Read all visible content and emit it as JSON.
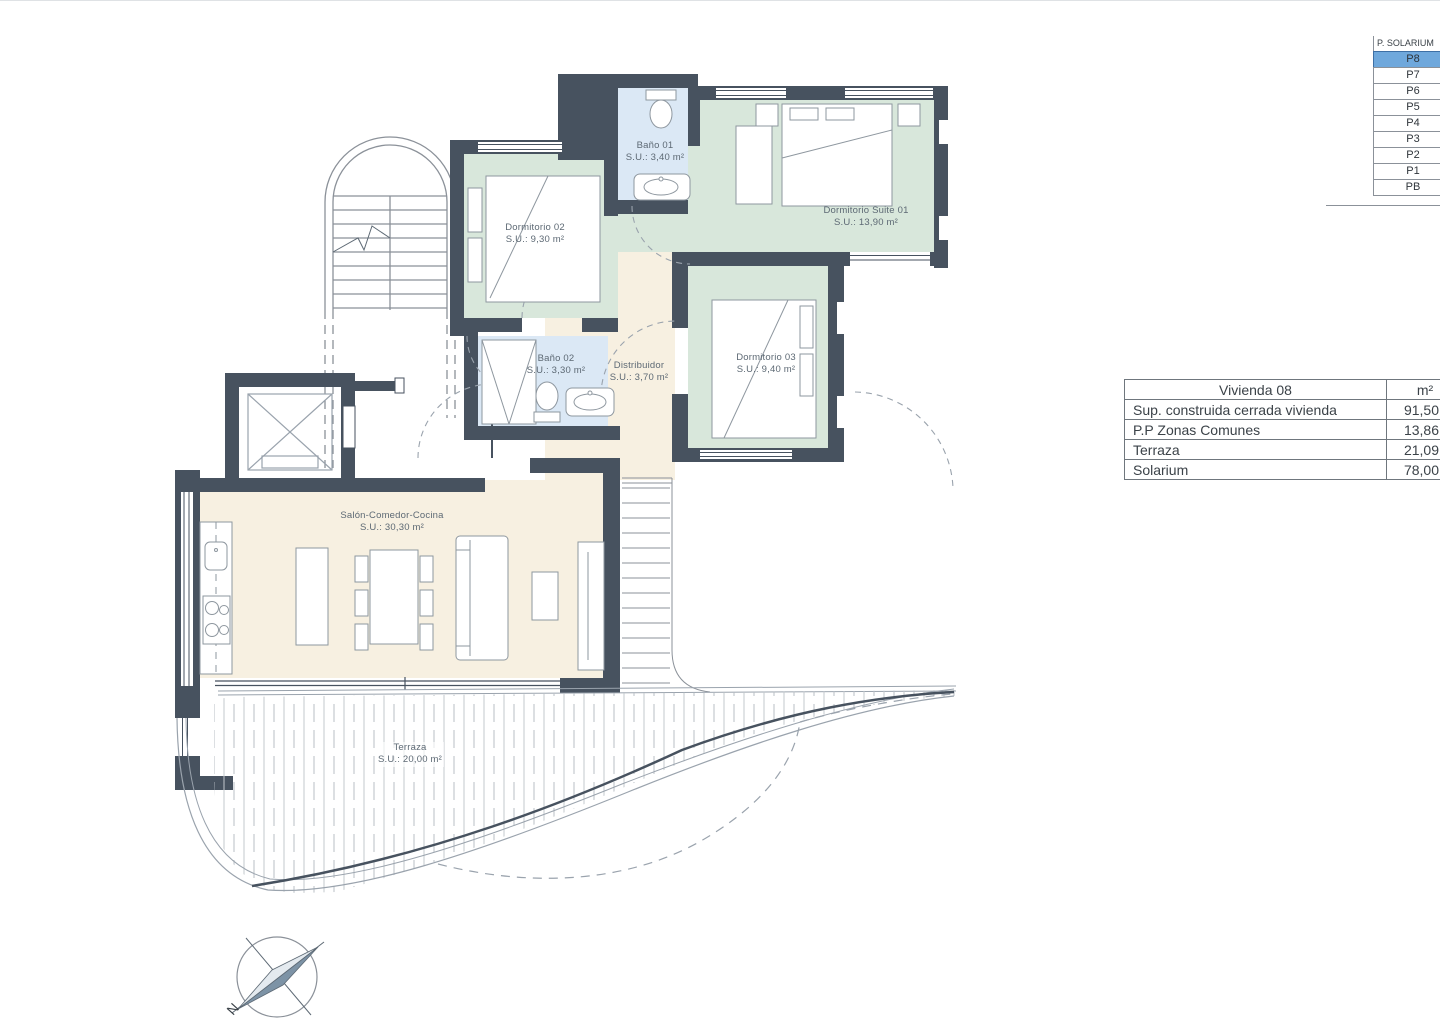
{
  "floor_selector": {
    "title": "P. SOLARIUM",
    "selected": "P8",
    "highlight_color": "#6fa8dc",
    "floors": [
      "P8",
      "P7",
      "P6",
      "P5",
      "P4",
      "P3",
      "P2",
      "P1",
      "PB"
    ]
  },
  "area_table": {
    "header": {
      "title": "Vivienda 08",
      "unit": "m²"
    },
    "rows": [
      {
        "label": "Sup. construida cerrada vivienda",
        "value": "91,50"
      },
      {
        "label": "P.P Zonas Comunes",
        "value": "13,86"
      },
      {
        "label": "Terraza",
        "value": "21,09"
      },
      {
        "label": "Solarium",
        "value": "78,00"
      }
    ]
  },
  "rooms": [
    {
      "name": "Baño 01",
      "area": "S.U.: 3,40 m²"
    },
    {
      "name": "Dormitorio 02",
      "area": "S.U.: 9,30 m²"
    },
    {
      "name": "Dormitorio Suite 01",
      "area": "S.U.: 13,90 m²"
    },
    {
      "name": "Dormitorio 03",
      "area": "S.U.: 9,40 m²"
    },
    {
      "name": "Baño 02",
      "area": "S.U.: 3,30 m²"
    },
    {
      "name": "Distribuidor",
      "area": "S.U.: 3,70 m²"
    },
    {
      "name": "Salón-Comedor-Cocina",
      "area": "S.U.: 30,30 m²"
    },
    {
      "name": "Terraza",
      "area": "S.U.: 20,00 m²"
    }
  ],
  "compass": {
    "north_label": "N"
  },
  "colors": {
    "wall": "#47525f",
    "room_green": "#d8e7db",
    "room_blue": "#dbe8f5",
    "room_cream": "#f7f0e1",
    "selected_floor": "#6fa8dc"
  }
}
